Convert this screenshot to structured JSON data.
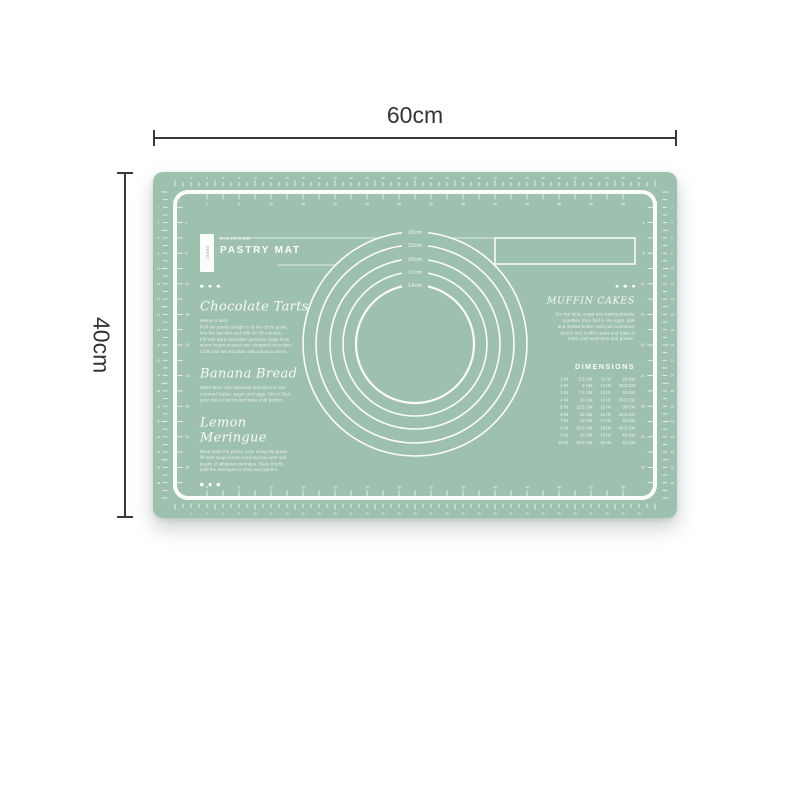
{
  "dimensions": {
    "width_label": "60cm",
    "height_label": "40cm",
    "line_color": "#3a3a3a"
  },
  "mat": {
    "color": "#9ec0af",
    "print_color": "#ffffff",
    "brand_vertical": "SWEET",
    "logo": {
      "subtitle": "SILICONE",
      "title": "PASTRY MAT"
    },
    "circles": {
      "labels": [
        "26cm",
        "23cm",
        "20cm",
        "17cm",
        "14cm"
      ],
      "radii": [
        112,
        99,
        85,
        72,
        59
      ]
    },
    "recipes": [
      {
        "title": "Chocolate Tarts",
        "lines": [
          "Makes 8 tarts",
          "Roll the pastry dough to fit the circle guide,",
          "line the tart tins and chill for 30 minutes.",
          "Fill with dark chocolate ganache made from",
          "warm cream poured over chopped chocolate.",
          "Chill until set and dust with cocoa to serve."
        ]
      },
      {
        "title": "Banana Bread",
        "lines": [
          "Mash three ripe bananas and fold into the",
          "creamed butter, sugar and eggs. Stir in flour,",
          "pour into a loaf tin and bake until golden."
        ]
      },
      {
        "title": "Lemon Meringue",
        "lines": [
          "Blind bake the pastry case using the guide,",
          "fill with tangy lemon curd and top with soft",
          "peaks of whipped meringue. Bake briefly",
          "until the meringue is crisp and golden."
        ]
      }
    ],
    "muffin": {
      "title": "MUFFIN CAKES",
      "lines": [
        "Stir the flour, sugar and baking powder",
        "together, then fold in the eggs, milk",
        "and melted butter until just combined.",
        "Spoon into muffin cases and bake at",
        "180C until well risen and golden."
      ]
    },
    "dimensions_table": {
      "title": "DIMENSIONS",
      "rows": [
        [
          "1 IN",
          "2.5 CM",
          "11 IN",
          "28 CM"
        ],
        [
          "2 IN",
          "5 CM",
          "12 IN",
          "30.5 CM"
        ],
        [
          "3 IN",
          "7.5 CM",
          "13 IN",
          "33 CM"
        ],
        [
          "4 IN",
          "10 CM",
          "14 IN",
          "35.5 CM"
        ],
        [
          "5 IN",
          "12.5 CM",
          "15 IN",
          "38 CM"
        ],
        [
          "6 IN",
          "15 CM",
          "16 IN",
          "40.5 CM"
        ],
        [
          "7 IN",
          "18 CM",
          "17 IN",
          "43 CM"
        ],
        [
          "8 IN",
          "20.5 CM",
          "18 IN",
          "45.5 CM"
        ],
        [
          "9 IN",
          "23 CM",
          "19 IN",
          "48 CM"
        ],
        [
          "10 IN",
          "25.5 CM",
          "20 IN",
          "51 CM"
        ]
      ]
    },
    "rulers": {
      "top_cm": 60,
      "side_cm": 40,
      "number_every_cm": 2
    }
  }
}
